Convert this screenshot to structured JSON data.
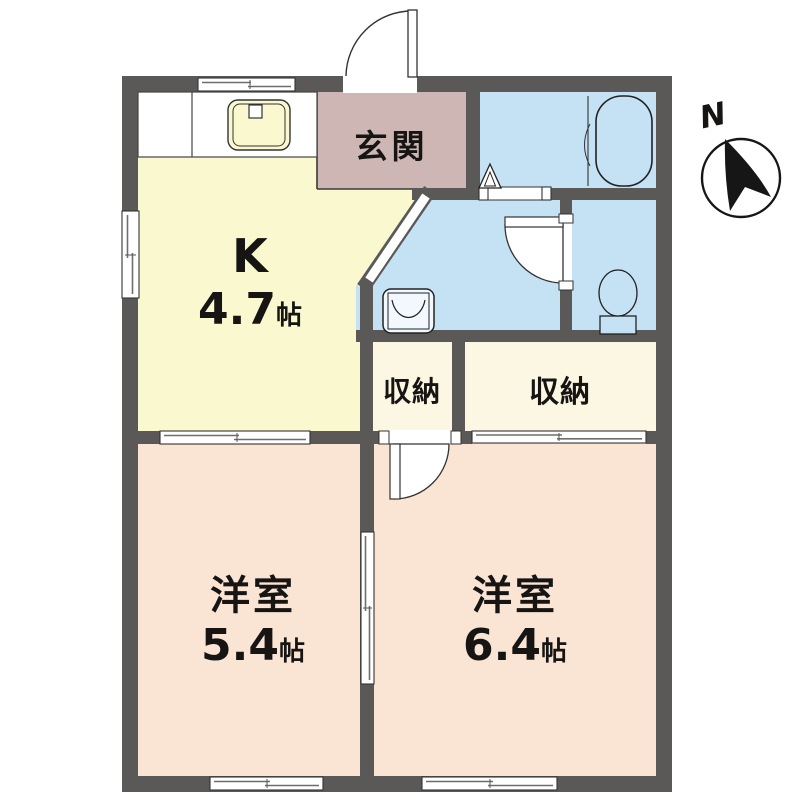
{
  "floor_plan": {
    "compass": {
      "north_label": "N"
    },
    "rooms": {
      "entrance": {
        "label": "玄関"
      },
      "kitchen": {
        "label": "K",
        "size_value": "4.7",
        "size_unit": "帖"
      },
      "storage_left": {
        "label": "収納"
      },
      "storage_right": {
        "label": "収納"
      },
      "western_room_left": {
        "label": "洋室",
        "size_value": "5.4",
        "size_unit": "帖"
      },
      "western_room_right": {
        "label": "洋室",
        "size_value": "6.4",
        "size_unit": "帖"
      }
    },
    "colors": {
      "wall": "#5a5957",
      "kitchen": "#faf8ce",
      "entrance": "#cdb6b3",
      "wet_area": "#c5e2f5",
      "storage": "#fbf7e2",
      "western_room": "#fae4d3",
      "outline": "#2e2c2b",
      "fixture_stroke": "#222222"
    }
  }
}
